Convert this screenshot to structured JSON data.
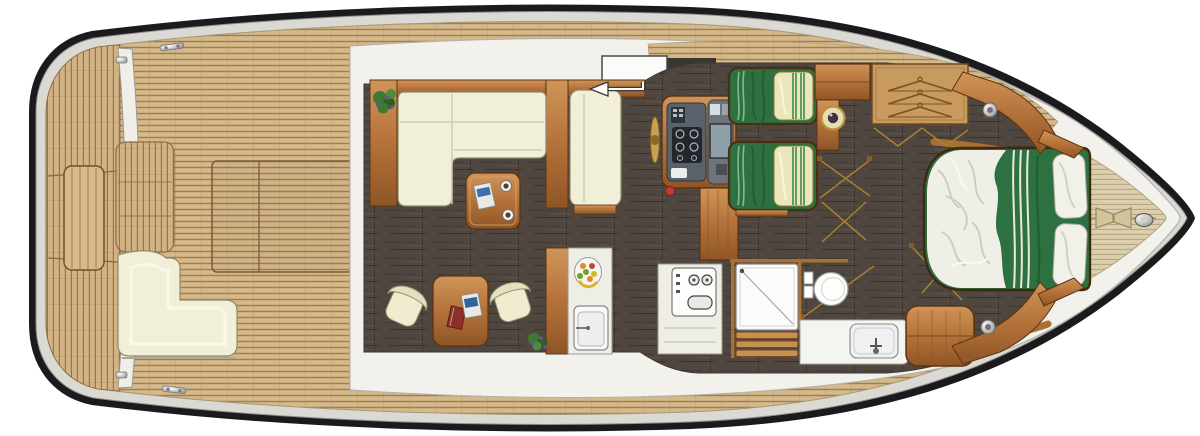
{
  "figure": {
    "kind": "motor-yacht-interior-deck-plan",
    "aria_label": "Top-down floor plan of a motor yacht, bow to the right",
    "orientation": {
      "bow": "right",
      "stern": "left"
    },
    "zones": [
      "swim-platform",
      "aft-cockpit",
      "salon",
      "dinette",
      "galley",
      "helm-station",
      "twin-guest-cabin",
      "wardrobe-corridor",
      "bathroom",
      "master-cabin",
      "bow-deck"
    ],
    "furniture": [
      "l-shaped-sofa",
      "coffee-table",
      "navigator-bench",
      "dining-table",
      "dining-chairs",
      "galley-counter",
      "galley-sink",
      "fruit-bowl",
      "stove-cooktop",
      "steering-wheel",
      "helm-console",
      "companionway-steps",
      "twin-bed",
      "twin-bed",
      "round-washbasin",
      "wardrobe",
      "shower",
      "toilet",
      "vanity-sink",
      "double-bed",
      "cockpit-bench",
      "engine-hatch",
      "anchor-hatch",
      "mooring-cleat"
    ],
    "colors": {
      "hull_line": "#1b1b1d",
      "rub_rail": "#dbd9d3",
      "teak": "#d5b98a",
      "teak_line": "#8f6b40",
      "bow_teak": "#dbcfae",
      "bow_teak_line": "#a6966d",
      "floor": "#4e463f",
      "floor_dark": "#3a332e",
      "wood_light": "#cf9558",
      "wood_mid": "#b4723a",
      "wood_dark": "#8f5526",
      "wood_edge": "#5d3413",
      "cushion": "#f2efd9",
      "cushion_edge": "#8d8868",
      "white_fixture": "#fbfbf9",
      "superstructure": "#f2f1ec",
      "green": "#2e7140",
      "green_dark": "#1d5a2f",
      "pillow": "#ece7bb",
      "pillow_stripe": "#3f8a4f",
      "duvet": "#efefe8",
      "metal": "#b9b9b6",
      "swing": "#a8802f",
      "red": "#c43a2e",
      "plant": "#3d7a33",
      "plant_accent": "#7a4a9a",
      "dash": "#59616a"
    }
  }
}
